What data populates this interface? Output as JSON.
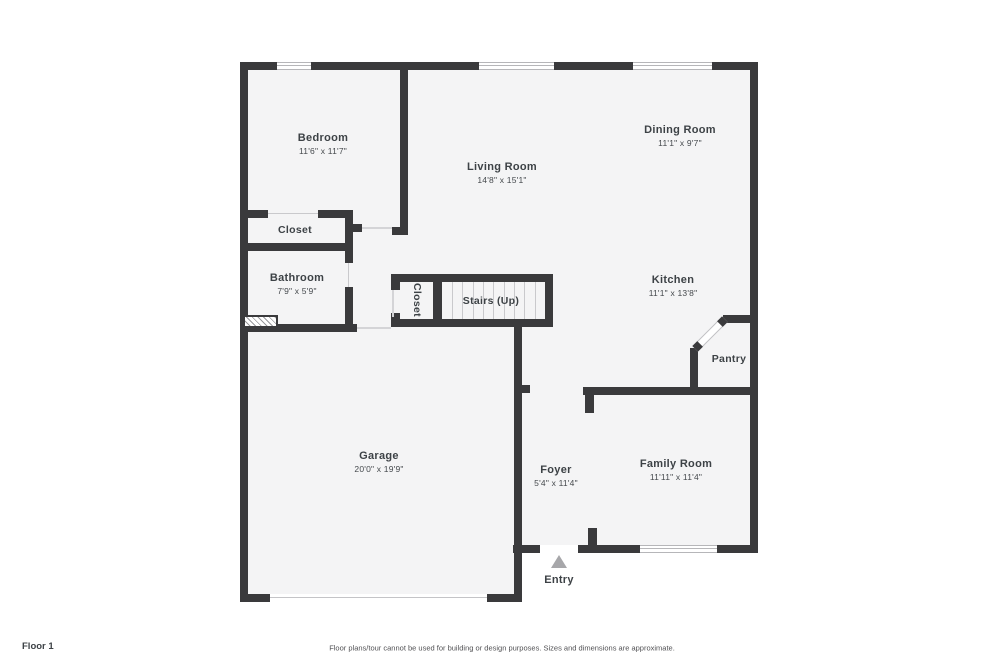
{
  "colors": {
    "wall": "#3a3a3c",
    "floor": "#f4f4f5",
    "entry_arrow": "#a7a7aa"
  },
  "rooms": {
    "bedroom": {
      "name": "Bedroom",
      "dims": "11'6\" x 11'7\""
    },
    "living": {
      "name": "Living Room",
      "dims": "14'8\" x 15'1\""
    },
    "dining": {
      "name": "Dining Room",
      "dims": "11'1\" x 9'7\""
    },
    "closet": {
      "name": "Closet"
    },
    "bathroom": {
      "name": "Bathroom",
      "dims": "7'9\" x 5'9\""
    },
    "stair_closet": {
      "name": "Closet"
    },
    "stairs": {
      "name": "Stairs (Up)"
    },
    "kitchen": {
      "name": "Kitchen",
      "dims": "11'1\" x 13'8\""
    },
    "pantry": {
      "name": "Pantry"
    },
    "garage": {
      "name": "Garage",
      "dims": "20'0\" x 19'9\""
    },
    "foyer": {
      "name": "Foyer",
      "dims": "5'4\" x 11'4\""
    },
    "family": {
      "name": "Family Room",
      "dims": "11'11\" x 11'4\""
    },
    "entry": {
      "name": "Entry"
    }
  },
  "footer": {
    "floor_label": "Floor 1",
    "disclaimer": "Floor plans/tour cannot be used for building or design purposes. Sizes and dimensions are approximate."
  }
}
